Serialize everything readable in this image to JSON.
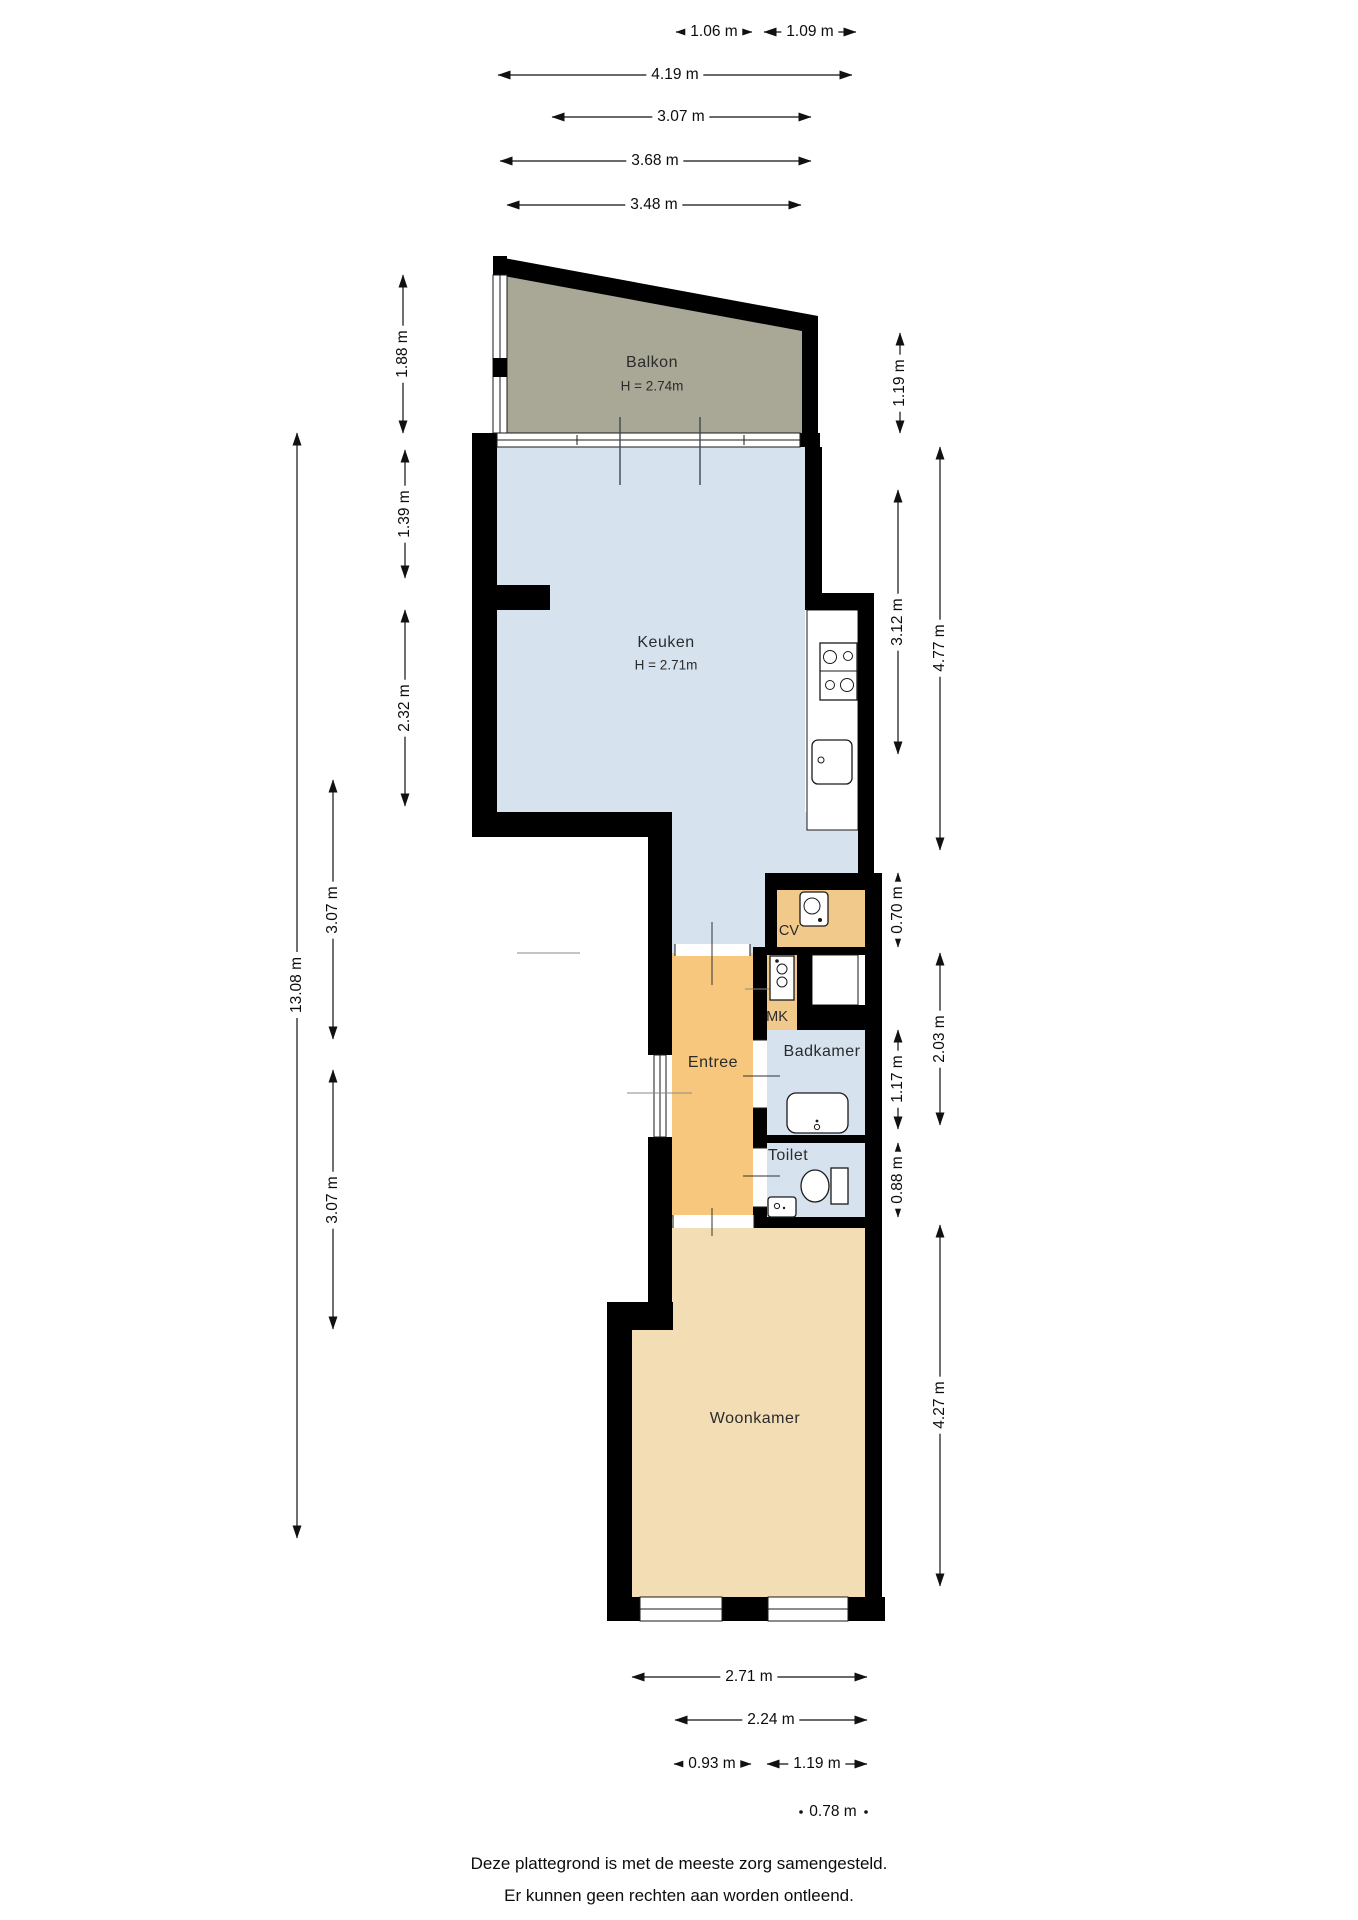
{
  "rooms": {
    "balkon": {
      "label": "Balkon",
      "height": "H = 2.74m"
    },
    "keuken": {
      "label": "Keuken",
      "height": "H = 2.71m"
    },
    "cv": {
      "label": "CV"
    },
    "mk": {
      "label": "MK"
    },
    "entree": {
      "label": "Entree"
    },
    "badkamer": {
      "label": "Badkamer"
    },
    "toilet": {
      "label": "Toilet"
    },
    "woonkamer": {
      "label": "Woonkamer"
    }
  },
  "dimensions": {
    "top": [
      {
        "label": "1.06 m"
      },
      {
        "label": "1.09 m"
      },
      {
        "label": "4.19 m"
      },
      {
        "label": "3.07 m"
      },
      {
        "label": "3.68 m"
      },
      {
        "label": "3.48 m"
      }
    ],
    "left": [
      {
        "label": "1.88 m"
      },
      {
        "label": "1.39 m"
      },
      {
        "label": "2.32 m"
      },
      {
        "label": "13.08 m"
      },
      {
        "label": "3.07 m"
      },
      {
        "label": "3.07 m"
      }
    ],
    "right": [
      {
        "label": "1.19 m"
      },
      {
        "label": "4.77 m"
      },
      {
        "label": "3.12 m"
      },
      {
        "label": "0.70 m"
      },
      {
        "label": "2.03 m"
      },
      {
        "label": "1.17 m"
      },
      {
        "label": "0.88 m"
      },
      {
        "label": "4.27 m"
      }
    ],
    "bottom": [
      {
        "label": "2.71 m"
      },
      {
        "label": "2.24 m"
      },
      {
        "label": "0.93 m"
      },
      {
        "label": "1.19 m"
      },
      {
        "label": "0.78 m"
      }
    ]
  },
  "footer": {
    "line1": "Deze plattegrond is met de meeste zorg samengesteld.",
    "line2": "Er kunnen geen rechten aan worden ontleend."
  },
  "colors": {
    "wall": "#000000",
    "balkon": "#a9a796",
    "wet_rooms": "#d7e2ef",
    "entree": "#f6c77c",
    "cv_mk": "#f0c98b",
    "woonkamer": "#f3ddb4"
  }
}
